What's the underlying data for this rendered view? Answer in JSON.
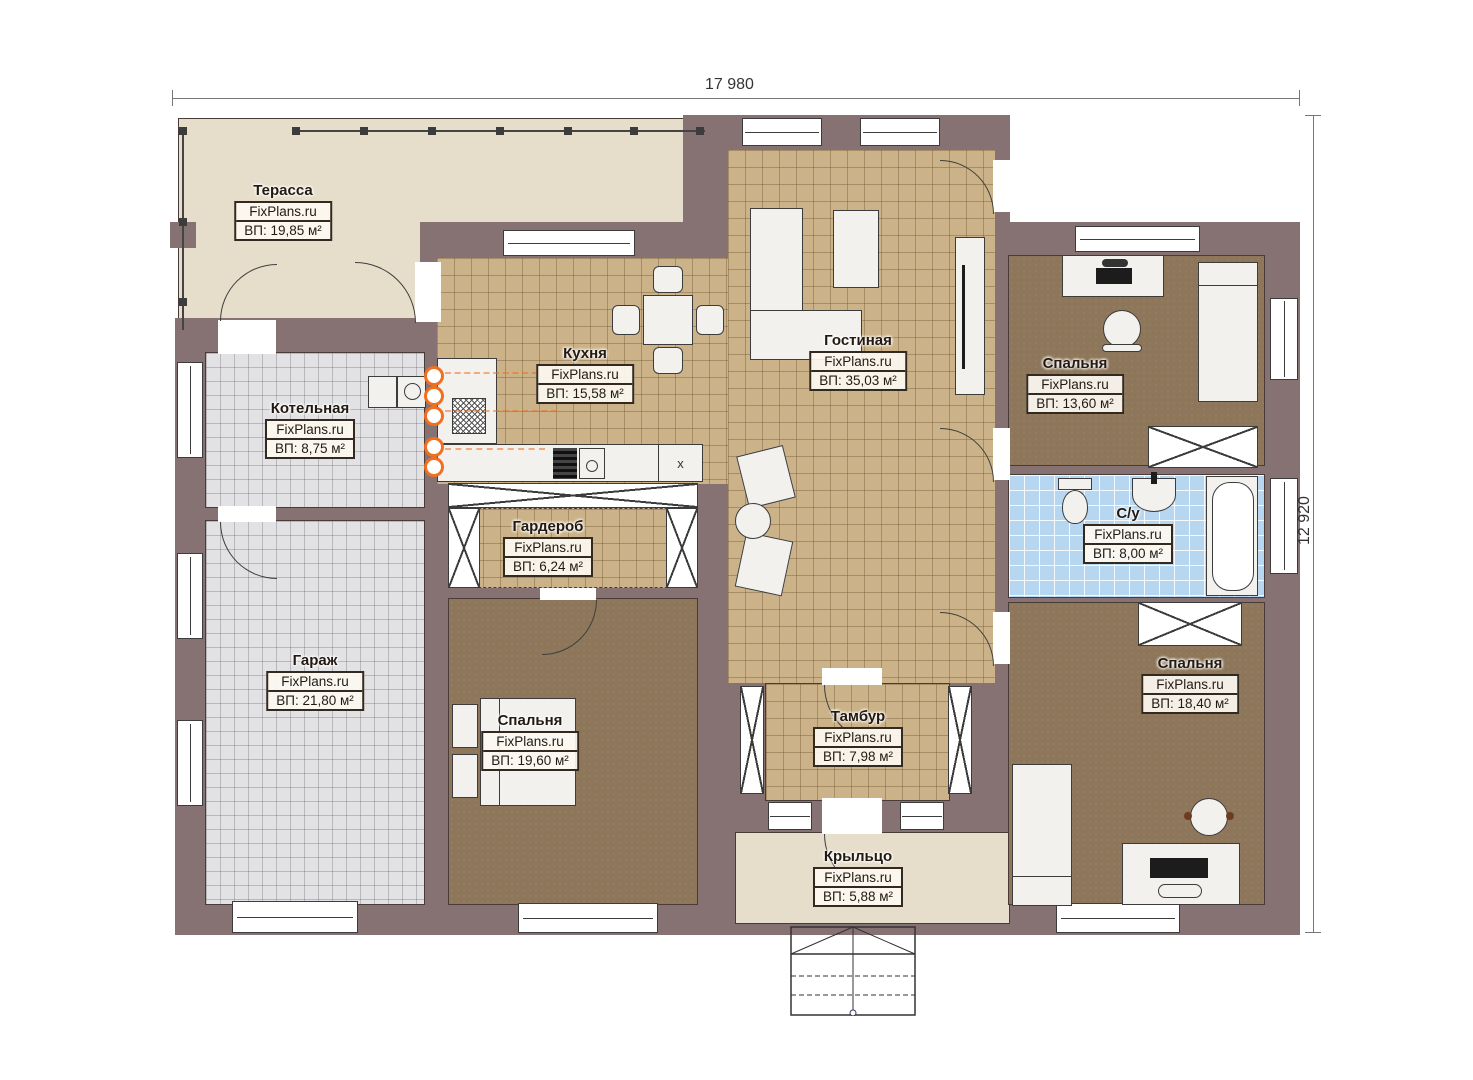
{
  "dimensions": {
    "width_label": "17 980",
    "height_label": "12 920"
  },
  "watermark": "FixPlans.ru",
  "rooms": [
    {
      "id": "terrace",
      "name": "Терасса",
      "site": "FixPlans.ru",
      "area": "ВП: 19,85 м²"
    },
    {
      "id": "kitchen",
      "name": "Кухня",
      "site": "FixPlans.ru",
      "area": "ВП: 15,58 м²"
    },
    {
      "id": "living-room",
      "name": "Гостиная",
      "site": "FixPlans.ru",
      "area": "ВП: 35,03 м²"
    },
    {
      "id": "boiler-room",
      "name": "Котельная",
      "site": "FixPlans.ru",
      "area": "ВП: 8,75 м²"
    },
    {
      "id": "wardrobe",
      "name": "Гардероб",
      "site": "FixPlans.ru",
      "area": "ВП: 6,24 м²"
    },
    {
      "id": "garage",
      "name": "Гараж",
      "site": "FixPlans.ru",
      "area": "ВП: 21,80 м²"
    },
    {
      "id": "bedroom-left",
      "name": "Спальня",
      "site": "FixPlans.ru",
      "area": "ВП: 19,60 м²"
    },
    {
      "id": "vestibule",
      "name": "Тамбур",
      "site": "FixPlans.ru",
      "area": "ВП: 7,98 м²"
    },
    {
      "id": "porch",
      "name": "Крыльцо",
      "site": "FixPlans.ru",
      "area": "ВП: 5,88 м²"
    },
    {
      "id": "bedroom-top-right",
      "name": "Спальня",
      "site": "FixPlans.ru",
      "area": "ВП: 13,60 м²"
    },
    {
      "id": "bathroom",
      "name": "С/у",
      "site": "FixPlans.ru",
      "area": "ВП: 8,00 м²"
    },
    {
      "id": "bedroom-bottom-right",
      "name": "Спальня",
      "site": "FixPlans.ru",
      "area": "ВП: 18,40 м²"
    }
  ],
  "labels": {
    "x_cabinet": "x"
  },
  "colors": {
    "wall": "#867173",
    "terrace_floor": "#e6ddca",
    "tile_floor": "#cbb288",
    "bedroom_floor": "#8d765a",
    "garage_floor": "#e2e2e4",
    "bath_floor": "#b7d6ef",
    "heating_accent": "#f07020"
  }
}
